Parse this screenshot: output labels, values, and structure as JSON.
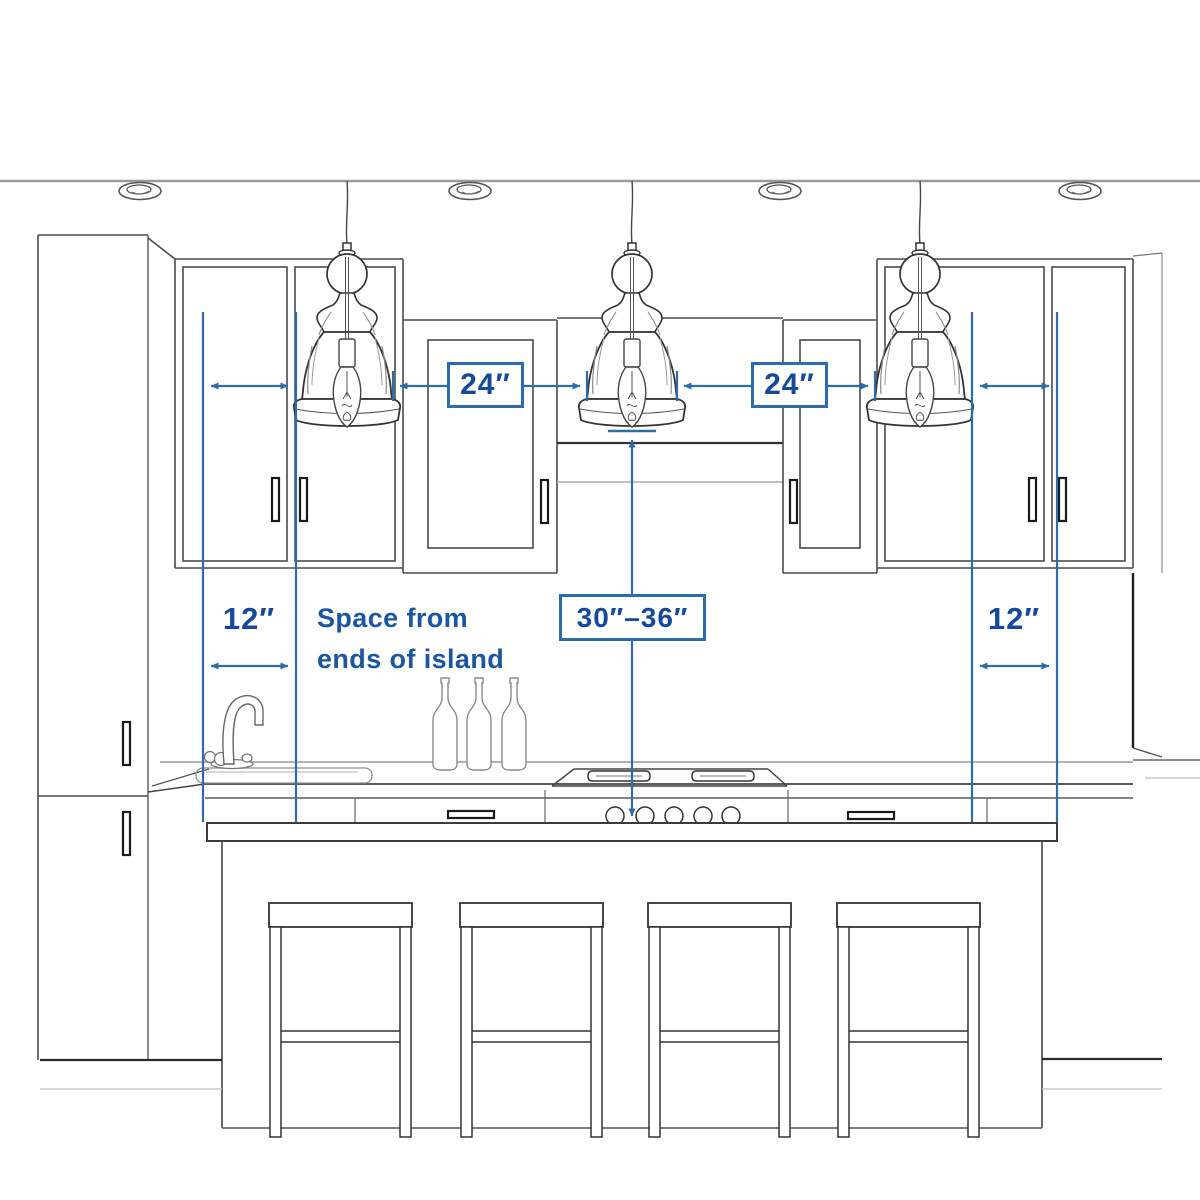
{
  "measurements": {
    "pendant_spacing_left": {
      "label": "24″"
    },
    "pendant_spacing_right": {
      "label": "24″"
    },
    "pendant_height_range": {
      "label": "30″–36″"
    },
    "island_end_left": {
      "label": "12″"
    },
    "island_end_right": {
      "label": "12″"
    },
    "island_end_note": {
      "line1": "Space from",
      "line2": "ends of island"
    }
  },
  "colors": {
    "measurement_line_blue": "#2D6CA8",
    "label_text_blue": "#17499B",
    "sketch_dark_gray": "#3F3F3F",
    "sketch_light_gray": "#A8A8A8",
    "background": "#FFFFFF"
  },
  "scene_objects": {
    "ceiling_recessed_light_count": 4,
    "pendant_light_count": 3,
    "bar_stool_count": 4,
    "wine_bottle_count": 3,
    "items": [
      "ceiling-recessed-light",
      "pendant-light",
      "pantry-cabinet",
      "upper-cabinet",
      "range-hood-opening",
      "kitchen-faucet",
      "sink",
      "wine-bottle",
      "gas-cooktop",
      "drawer",
      "kitchen-island",
      "bar-stool"
    ]
  }
}
